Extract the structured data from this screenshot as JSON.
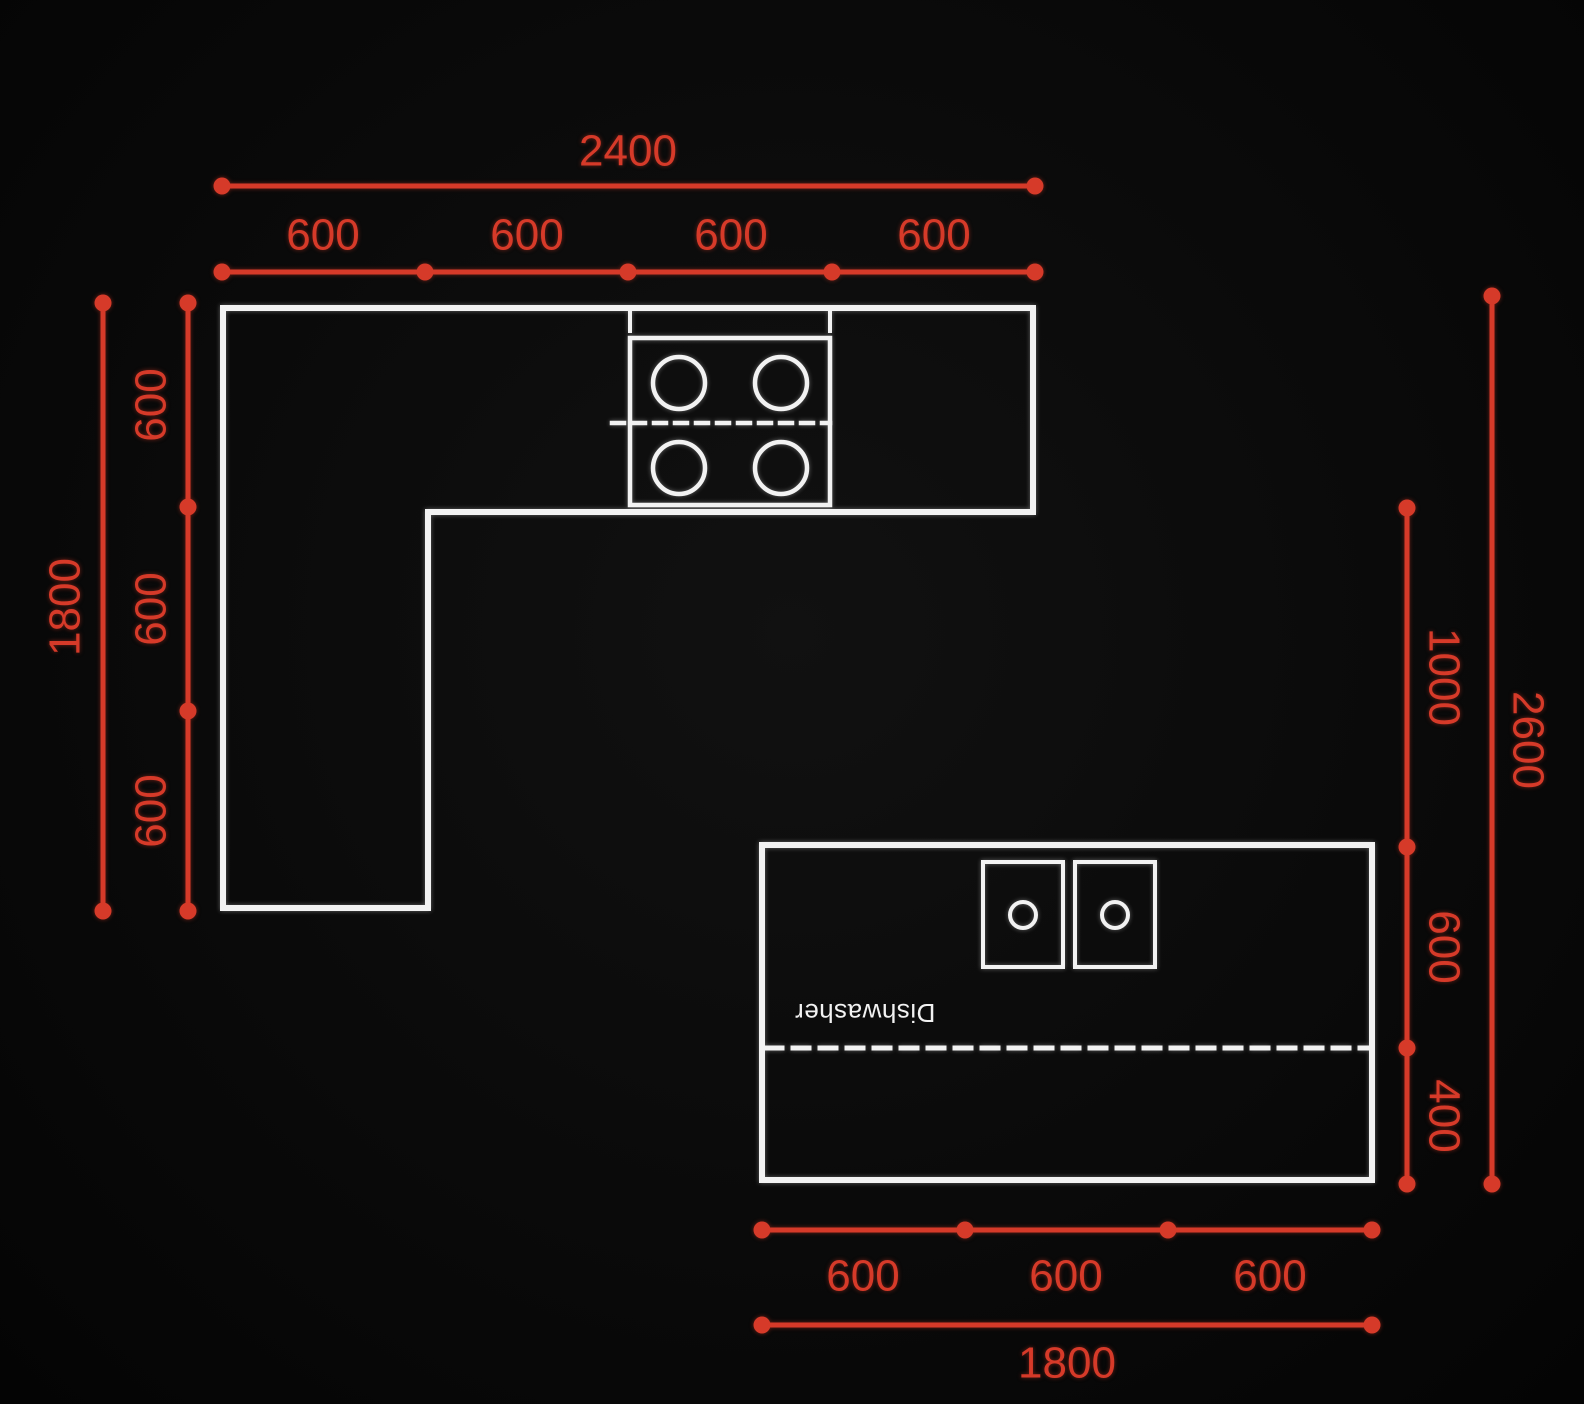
{
  "colors": {
    "background": "#0a0a0a",
    "outline": "#f2f2f2",
    "dimension": "#d63a29"
  },
  "labels": {
    "dishwasher": "Dishwasher"
  },
  "dimensions": {
    "top": {
      "total": "2400",
      "segments": [
        "600",
        "600",
        "600",
        "600"
      ]
    },
    "left": {
      "total": "1800",
      "segments": [
        "600",
        "600",
        "600"
      ]
    },
    "right": {
      "total": "2600",
      "segments": [
        "1000",
        "600",
        "400"
      ]
    },
    "bottom": {
      "total": "1800",
      "segments": [
        "600",
        "600",
        "600"
      ]
    }
  }
}
